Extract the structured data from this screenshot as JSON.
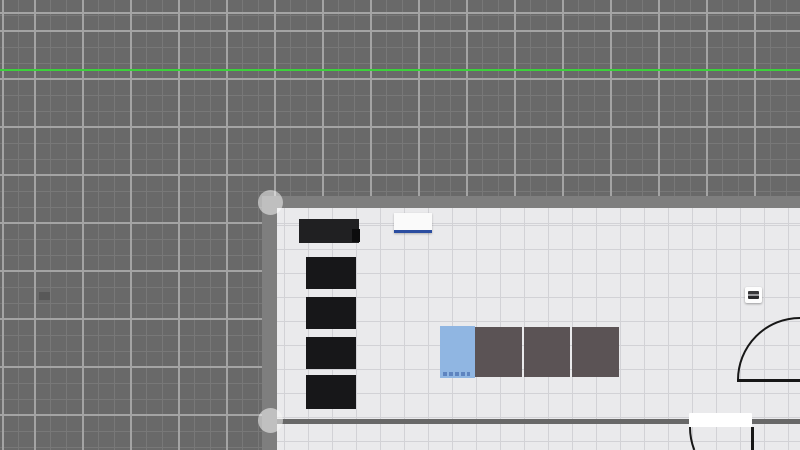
{
  "app": {
    "description": "floor plan editor canvas, no visible text",
    "canvas_width": 800,
    "canvas_height": 450
  },
  "colors": {
    "outdoor_base": "#696969",
    "outdoor_grid_minor": "#787878",
    "outdoor_grid_major": "#a4a4a4",
    "reference_green": "#3bd13b",
    "wall_gray": "#7e7e7e",
    "interior_wall_gray": "#686868",
    "floor": "#eaeaec",
    "floor_grid": "#d2d2d6",
    "furniture_black": "#1c1c1e",
    "couch_dark": "#5b5355",
    "item_blue": "#90b6e2",
    "item_blue_dashes": "#5e84bf",
    "sink_white": "#fafafa",
    "sink_accent_blue": "#2b4da0",
    "door_stroke": "#171717",
    "handle_white": "rgba(255,255,255,0.5)"
  },
  "scene": {
    "reference_line": {
      "y": 70,
      "style": "left:0;top:69px;width:800px;height:2px;background:#3bd13b;"
    },
    "outdoor_marker": {
      "style": "left:39px;top:292px;width:11px;height:8px;background:#585858;"
    },
    "floor": {
      "style": "left:277px;top:208px;width:523px;height:242px;"
    },
    "walls": {
      "top": {
        "style": "left:262px;top:196px;width:538px;height:12px;background:#7e7e7e;"
      },
      "left": {
        "style": "left:262px;top:196px;width:15px;height:254px;background:#7e7e7e;"
      },
      "interior": {
        "style": "left:277px;top:419px;width:523px;height:5px;background:#686868;"
      }
    },
    "handles": {
      "top_corner": {
        "style": "left:258px;top:190px;width:25px;height:25px;border-radius:50%;background:rgba(255,255,255,0.5);"
      },
      "bottom_corner": {
        "style": "left:258px;top:408px;width:25px;height:25px;border-radius:50%;background:rgba(245,245,245,0.55);"
      }
    },
    "furniture": {
      "cabinet": {
        "style": "left:299px;top:219px;width:60px;height:24px;background:#202022;"
      },
      "cabinet_notch": {
        "style": "left:352px;top:229px;width:8px;height:13px;background:#0c0c0d;"
      },
      "shelf_1": {
        "style": "left:306px;top:257px;width:50px;height:32px;background:#171719;"
      },
      "shelf_2": {
        "style": "left:306px;top:297px;width:50px;height:32px;background:#171719;"
      },
      "shelf_3": {
        "style": "left:306px;top:337px;width:50px;height:32px;background:#171719;"
      },
      "shelf_4": {
        "style": "left:306px;top:375px;width:50px;height:34px;background:#171719;"
      },
      "sink": {
        "style": "left:394px;top:213px;width:38px;height:17px;background:#fafafa;border-bottom:3px solid #2b4da0;box-shadow:0 1px 2px rgba(0,0,0,0.25);"
      },
      "blue_item": {
        "style": "left:440px;top:326px;width:35px;height:52px;background:#90b6e2;"
      },
      "blue_item_dashes": {
        "style": "left:443px;top:372px;width:27px;height:4px;background:repeating-linear-gradient(90deg,#5e84bf 0 4px,transparent 4px 6px);"
      },
      "couch": {
        "style": "left:475px;top:327px;width:144px;height:50px;"
      },
      "outlet": {
        "style": "left:745px;top:287px;width:17px;height:16px;background:#fdfdfd;border-radius:2px;box-shadow:0 1px 2px rgba(0,0,0,0.35);"
      },
      "outlet_inner": {
        "style": "left:748px;top:291px;width:11px;height:8px;border-radius:1px;background:linear-gradient(#38383a 0 3px,#9a9a9d 3px 5px,#28282a 5px 8px);"
      }
    },
    "doors": {
      "right": {
        "leaf_d": "M 737 380.5 L 800 380.5",
        "arc_d": "M 738 380 A 62 62 0 0 1 800 318"
      },
      "bottom": {
        "gap_style": "left:689px;top:413px;width:63px;height:14px;background:#ffffff;border-radius:1px;",
        "leaf_d": "M 752.5 427 L 752.5 450",
        "arc_d": "M 690 427 A 63 63 0 0 0 694.3 450"
      }
    }
  }
}
